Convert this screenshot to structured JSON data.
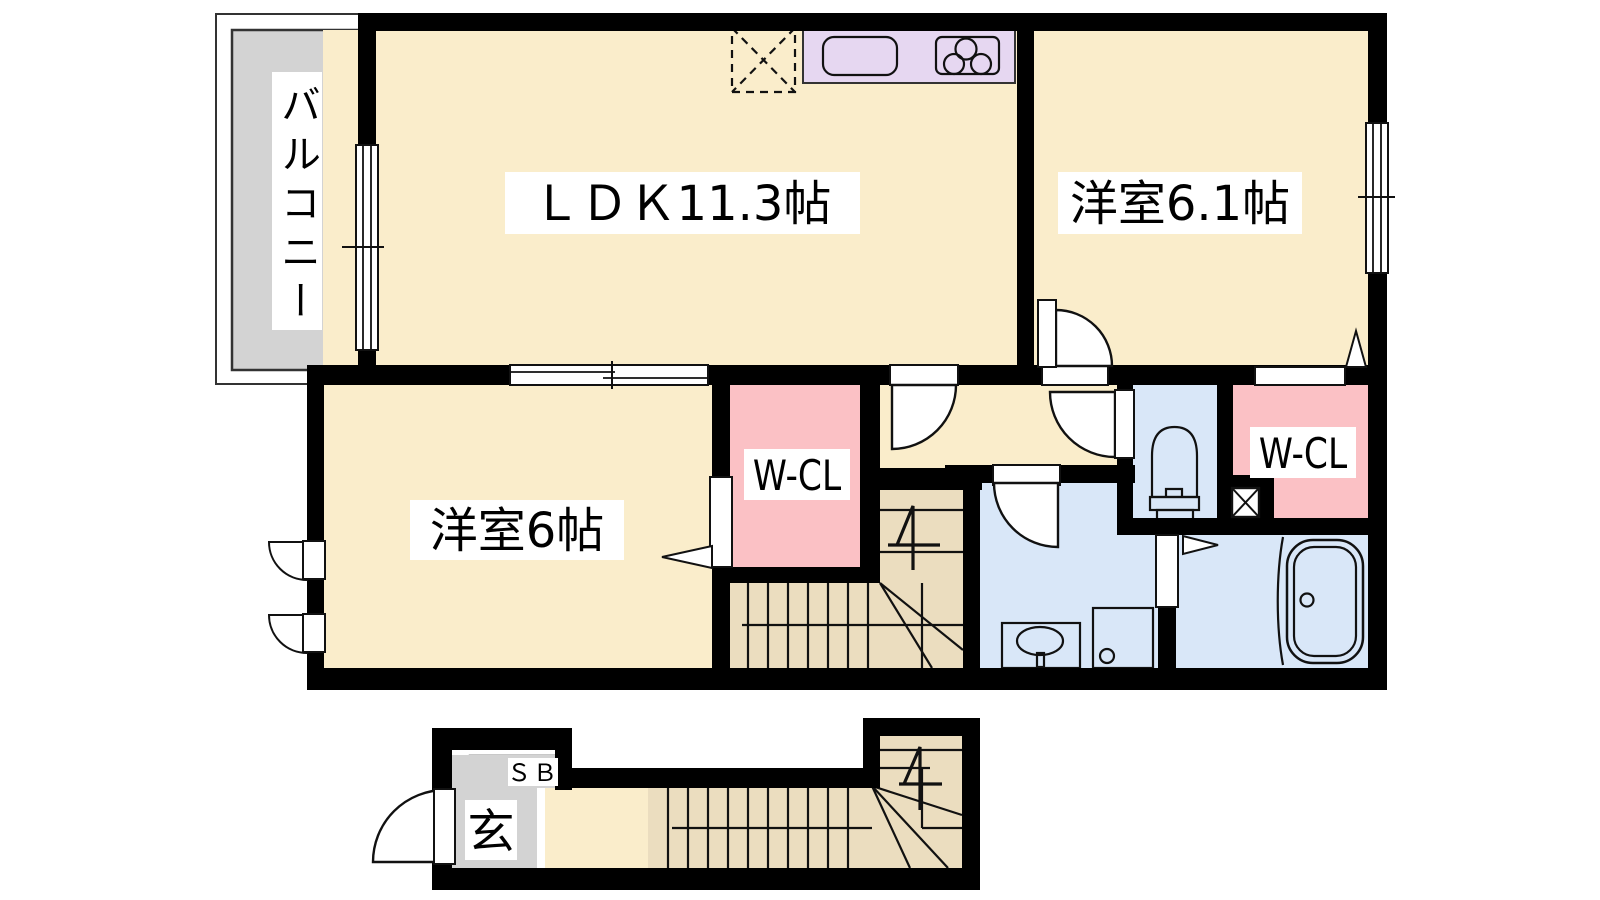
{
  "plan": {
    "title": "2LDK apartment floor plan",
    "labels": {
      "balcony": "バルコニー",
      "ldk": "ＬＤＫ11.3帖",
      "western_room_61": "洋室6.1帖",
      "western_room_6": "洋室6帖",
      "wcl_left": "W-CL",
      "wcl_right": "W-CL",
      "shoe_box": "ＳＢ",
      "entrance": "玄"
    },
    "colors": {
      "floor_cream": "#FAEDCB",
      "balcony_gray": "#D3D3D3",
      "kitchen_lavender": "#E6D7F1",
      "closet_pink": "#FBC1C5",
      "wet_area_blue": "#D9E7F8",
      "stairs_tan": "#EBDDBF",
      "entrance_gray": "#D3D3D3",
      "wall_black": "#000000",
      "label_bg": "#FFFFFF"
    },
    "fixtures": [
      "refrigerator-space-icon",
      "kitchen-sink-icon",
      "gas-stove-icon",
      "toilet-icon",
      "washbasin-icon",
      "washing-machine-space-icon",
      "bathtub-icon",
      "pipe-space-x-icon",
      "staircase-up-2f-icon",
      "staircase-up-1f-icon",
      "door-swing-icon",
      "sliding-door-icon",
      "window-icon"
    ]
  }
}
